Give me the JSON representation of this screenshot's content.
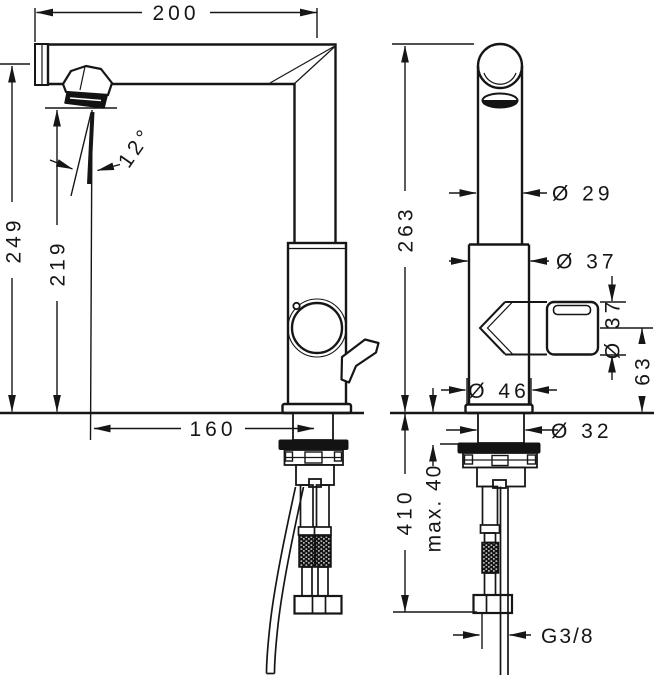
{
  "drawing": {
    "type": "faucet-dimensional-technical-drawing",
    "views": [
      "side-view",
      "front-view"
    ],
    "colors": {
      "line": "#161616",
      "background": "#ffffff"
    }
  },
  "dimensions": {
    "spout_reach": "200",
    "height_to_top": "249",
    "height_to_outlet": "219",
    "stream_angle": "12°",
    "outlet_offset": "160",
    "height_overall": "263",
    "spout_pipe_diameter": "Ø 29",
    "body_diameter": "Ø 37",
    "handle_knob_diameter": "Ø 37",
    "handle_center_height": "63",
    "base_diameter": "Ø 46",
    "shank_diameter": "Ø 32",
    "hose_drop_length": "410",
    "max_mounting_thickness": "max. 40",
    "supply_thread": "G3/8"
  }
}
